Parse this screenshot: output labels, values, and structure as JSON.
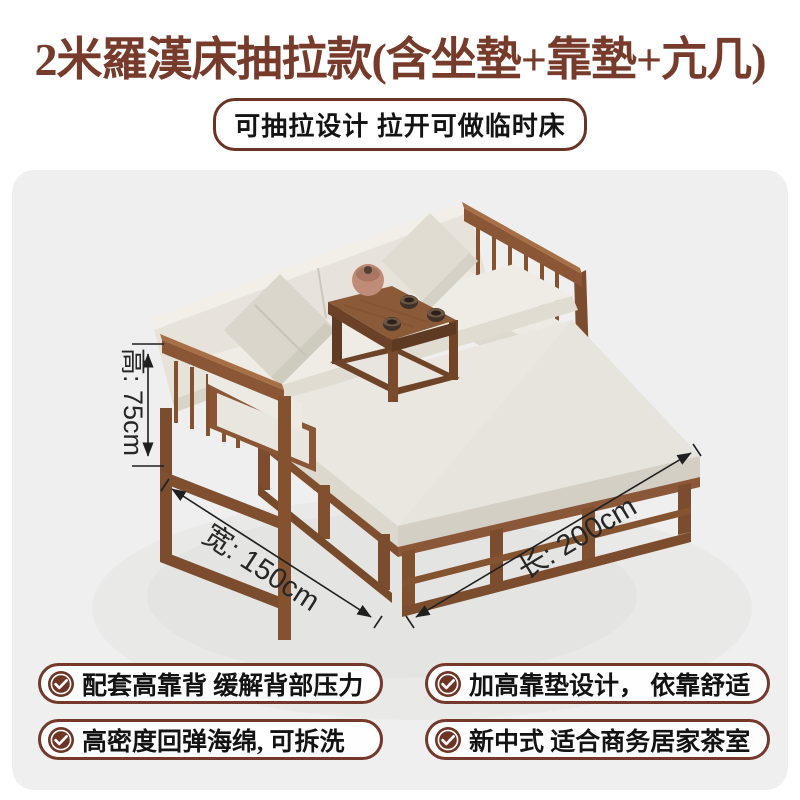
{
  "header": {
    "title": "2米羅漢床抽拉款(含坐墊+靠墊+亢几)",
    "subtitle_badge": "可抽拉设计 拉开可做临时床"
  },
  "showcase": {
    "dimension_labels": {
      "height": "高: 75cm",
      "width": "宽: 150cm",
      "length": "长: 200cm"
    }
  },
  "features": [
    {
      "text": "配套高靠背 缓解背部压力"
    },
    {
      "text": "加高靠垫设计， 依靠舒适"
    },
    {
      "text": "高密度回弹海绵, 可拆洗"
    },
    {
      "text": "新中式 适合商务居家茶室"
    }
  ],
  "colors": {
    "accent_brown": "#74392a",
    "panel_bg": "#efeff0",
    "wood": "#8a5636",
    "cushion": "#eae7e0",
    "dimension_text": "#262626"
  }
}
